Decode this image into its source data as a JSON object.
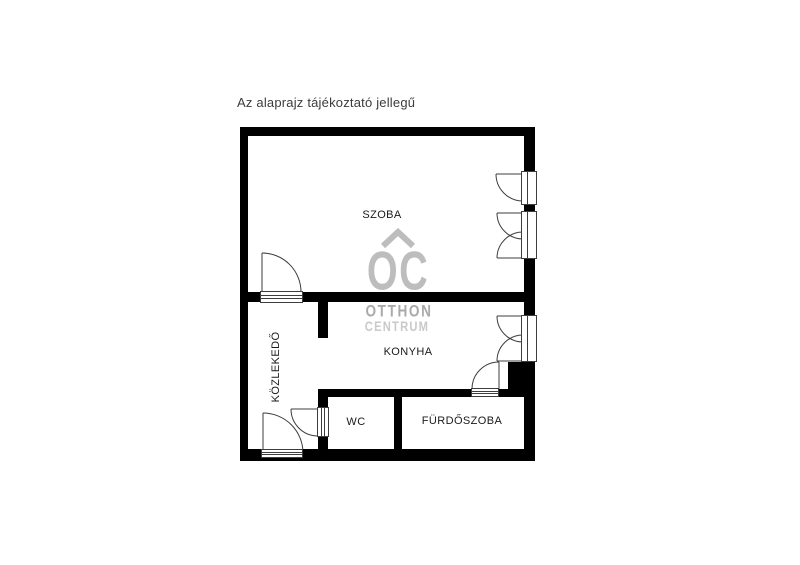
{
  "title": "Az alaprajz tájékoztató jellegű",
  "watermark": {
    "logo": "OC",
    "line1": "OTTHON",
    "line2": "CENTRUM"
  },
  "rooms": {
    "szoba": {
      "label": "SZOBA"
    },
    "kozlekedo": {
      "label": "KÖZLEKEDŐ"
    },
    "konyha": {
      "label": "KONYHA"
    },
    "wc": {
      "label": "WC"
    },
    "furdoszoba": {
      "label": "FÜRDŐSZOBA"
    }
  },
  "icons": {
    "roof_icon": "chevron roof over OC logo"
  },
  "colors": {
    "wall": "#000000",
    "line": "#3d3d3d",
    "label_text": "#1a1a1a",
    "title_text": "#3c3c3c",
    "watermark_logo": "#bdbdbd",
    "watermark_line1": "#a9a9a9",
    "watermark_line2": "#c9c9c9"
  }
}
